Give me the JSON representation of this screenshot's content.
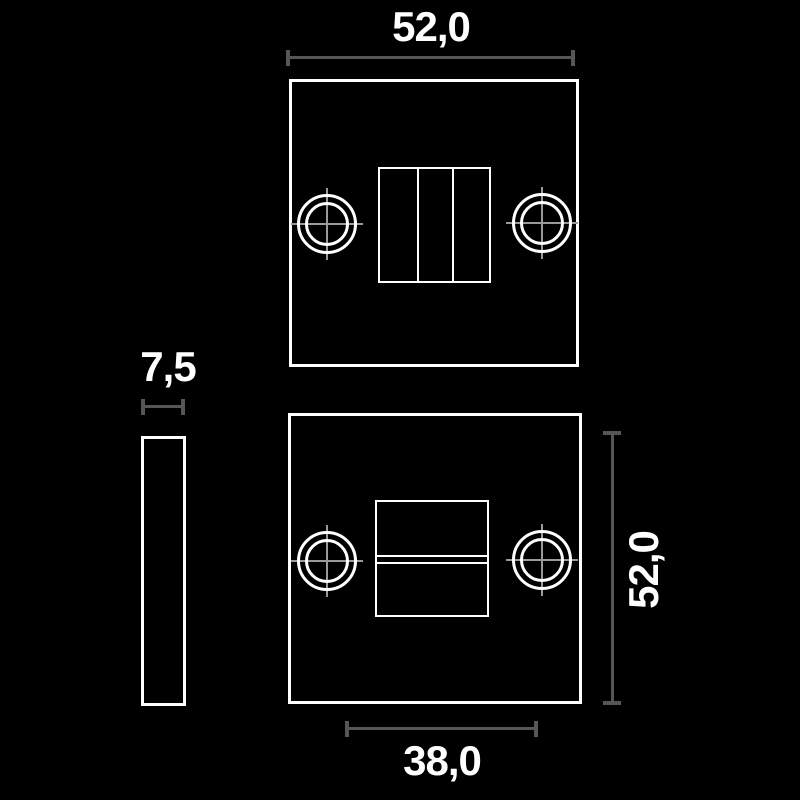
{
  "figure": {
    "type": "technical-drawing",
    "background_color": "#000000",
    "outline_color": "#ffffff",
    "dimension_line_color": "#565656",
    "crosshair_color": "#9a9a9a",
    "text_color": "#ffffff"
  },
  "dimension_labels": {
    "top_width": "52,0",
    "side_thickness": "7,5",
    "right_height": "52,0",
    "bottom_inner_width": "38,0"
  }
}
